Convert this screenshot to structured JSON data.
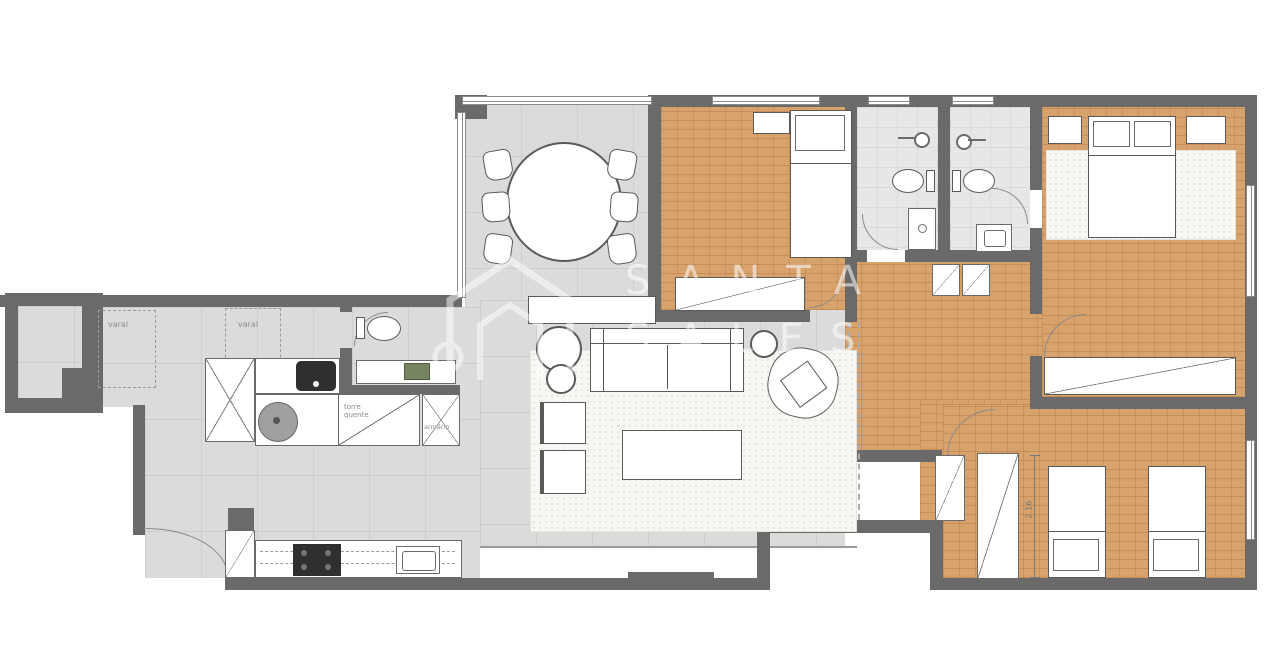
{
  "watermark": {
    "logo_icon": "house-outline-logo",
    "line1": "SANTA",
    "line2": "SALES"
  },
  "plan_labels": {
    "varal_1": "varal",
    "varal_2": "varal",
    "torre_quente": "torre quente",
    "armario": "armário",
    "dimension_bedroom3": "2.16"
  },
  "colors": {
    "wall": "#6a6a6a",
    "floor_tile": "#dbdbdb",
    "floor_wood_orange": "#d8a26d",
    "floor_bath": "#e7e7e7",
    "rug": "#f7f7f3",
    "sink_green": "#76845f",
    "appliance_dark": "#2f2f2f",
    "watermark_text": "rgba(255,255,255,0.55)"
  },
  "symbols": [
    "dining-table",
    "dining-chair",
    "sideboard",
    "sofa",
    "armchair",
    "coffee-table",
    "side-table",
    "plant",
    "area-rug",
    "single-bed",
    "double-bed",
    "pillow",
    "nightstand",
    "wardrobe",
    "closet",
    "toilet",
    "sink",
    "vanity",
    "shower-head",
    "washing-machine",
    "laundry-tub",
    "stove-cooktop",
    "kitchen-sink",
    "door-arc",
    "window",
    "clothesline-area",
    "dimension-line"
  ]
}
